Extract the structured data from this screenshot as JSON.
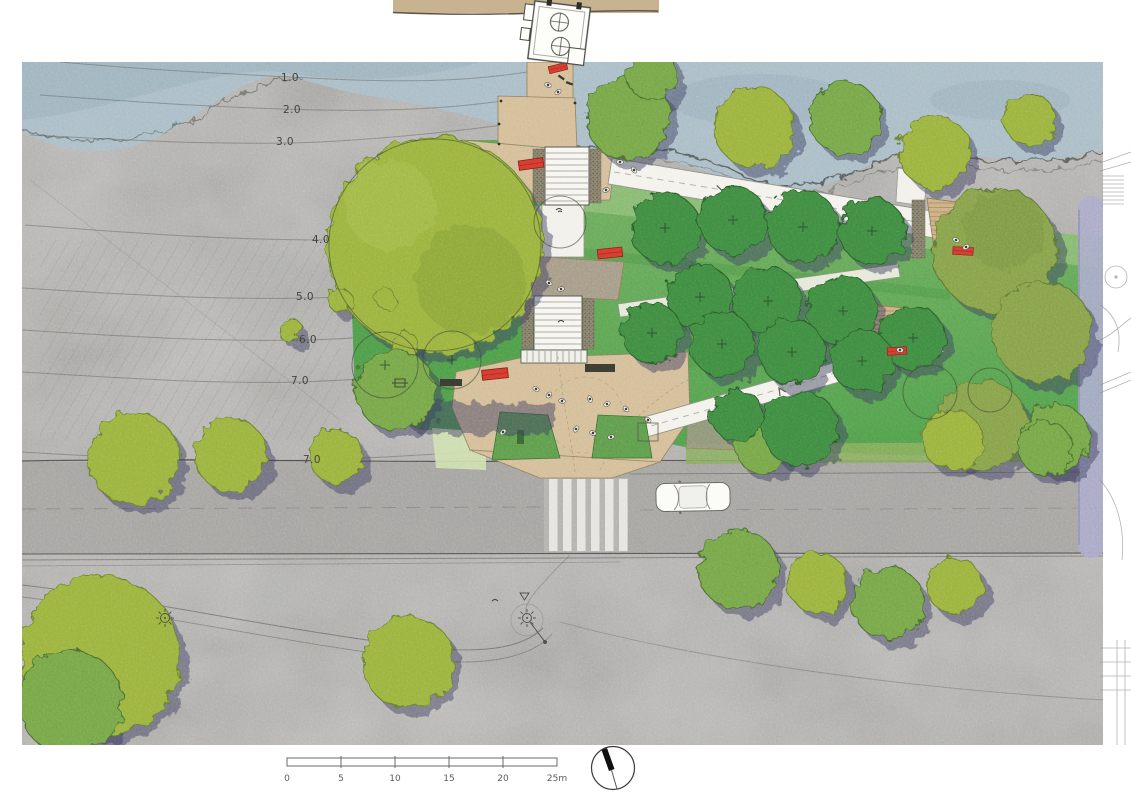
{
  "palette": {
    "water": "#a9bdc7",
    "photo_gray": "#b5b4b1",
    "lawn_green": "#56a251",
    "canopy_yellow_green": "#9ab23f",
    "canopy_mid_green": "#74a548",
    "canopy_dark_green": "#3f8a42",
    "shadow_purple": "#3d3d5f",
    "paving_tan": "#d4bd97",
    "timber_deck": "#ccae84",
    "bench_red": "#d6392f",
    "road_gray": "#a3a29f",
    "ramp_white": "#f3f2ec",
    "path_lavender": "#a8a8ca",
    "top_band_tan": "#c8b391"
  },
  "icons": {
    "north_arrow": "north-arrow-icon",
    "light_fixture": "sun-icon"
  },
  "plan": {
    "contour_labels": [
      {
        "text": "1.0"
      },
      {
        "text": "2.0"
      },
      {
        "text": "3.0"
      },
      {
        "text": "4.0"
      },
      {
        "text": "5.0"
      },
      {
        "text": "6.0"
      },
      {
        "text": "7.0"
      },
      {
        "text": "7.0"
      }
    ]
  },
  "scale_bar": {
    "unit": "m",
    "tick_labels": [
      "0",
      "5",
      "10",
      "15",
      "20",
      "25m"
    ]
  }
}
